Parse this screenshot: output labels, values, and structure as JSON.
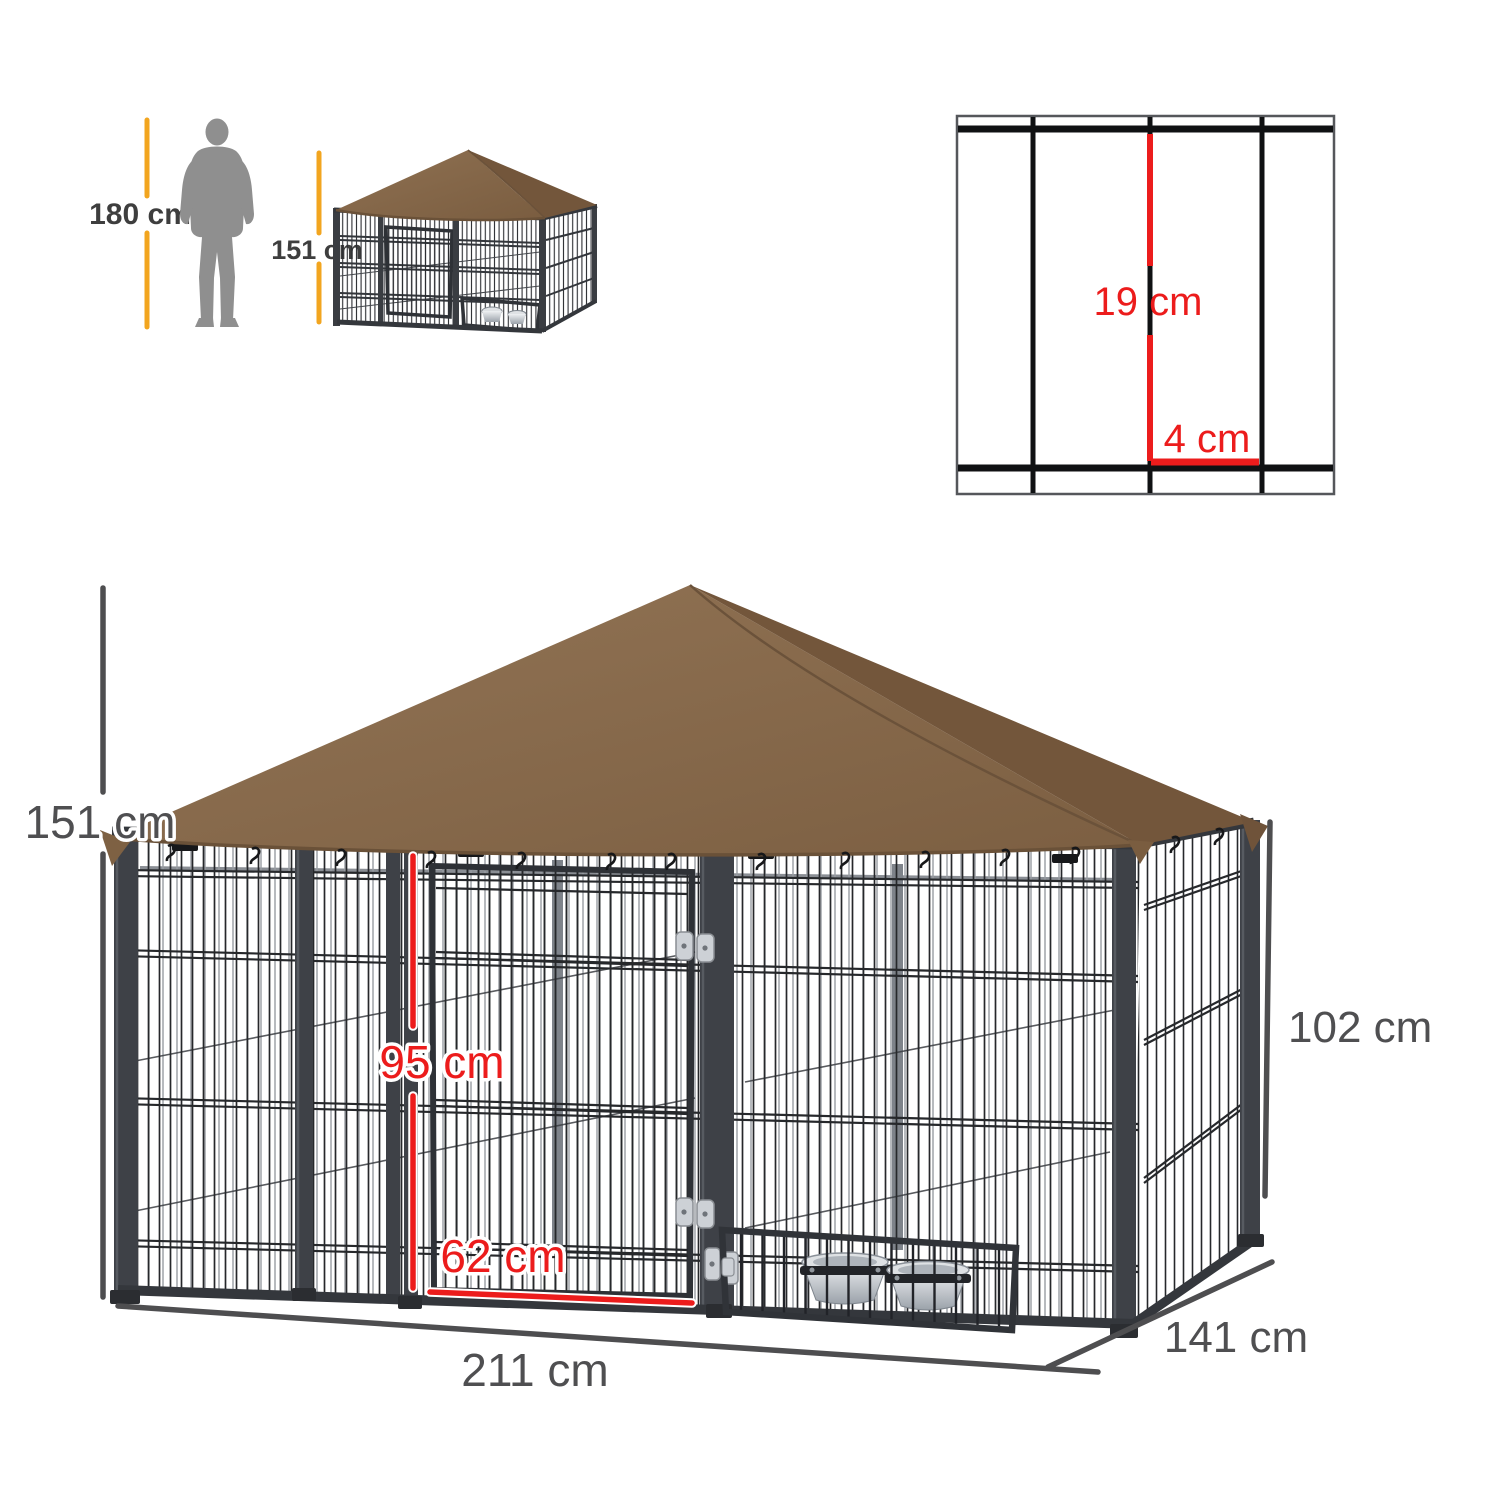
{
  "scale_reference": {
    "person_label": "180 cm",
    "kennel_label": "151 cm"
  },
  "mesh_detail": {
    "vertical_spacing_label": "19 cm",
    "horizontal_spacing_label": "4 cm"
  },
  "dimensions": {
    "overall_height_label": "151 cm",
    "door_height_label": "95 cm",
    "door_width_label": "62 cm",
    "side_panel_height_label": "102 cm",
    "overall_width_label": "211 cm",
    "overall_depth_label": "141 cm"
  },
  "colors": {
    "roof_brown": "#87694a",
    "roof_brown_dark": "#73563b",
    "roof_edge": "#6a5138",
    "accent_red": "#ec1c1c",
    "accent_yellow": "#f2a51f",
    "dimension_gray": "#4e4e50",
    "silhouette_gray": "#8f8f8f",
    "frame_dark": "#3e4147",
    "wire_black": "#26282b",
    "hinge_gray": "#cdd1d6",
    "bowl_silver": "#d9dcdf",
    "background": "#ffffff"
  }
}
